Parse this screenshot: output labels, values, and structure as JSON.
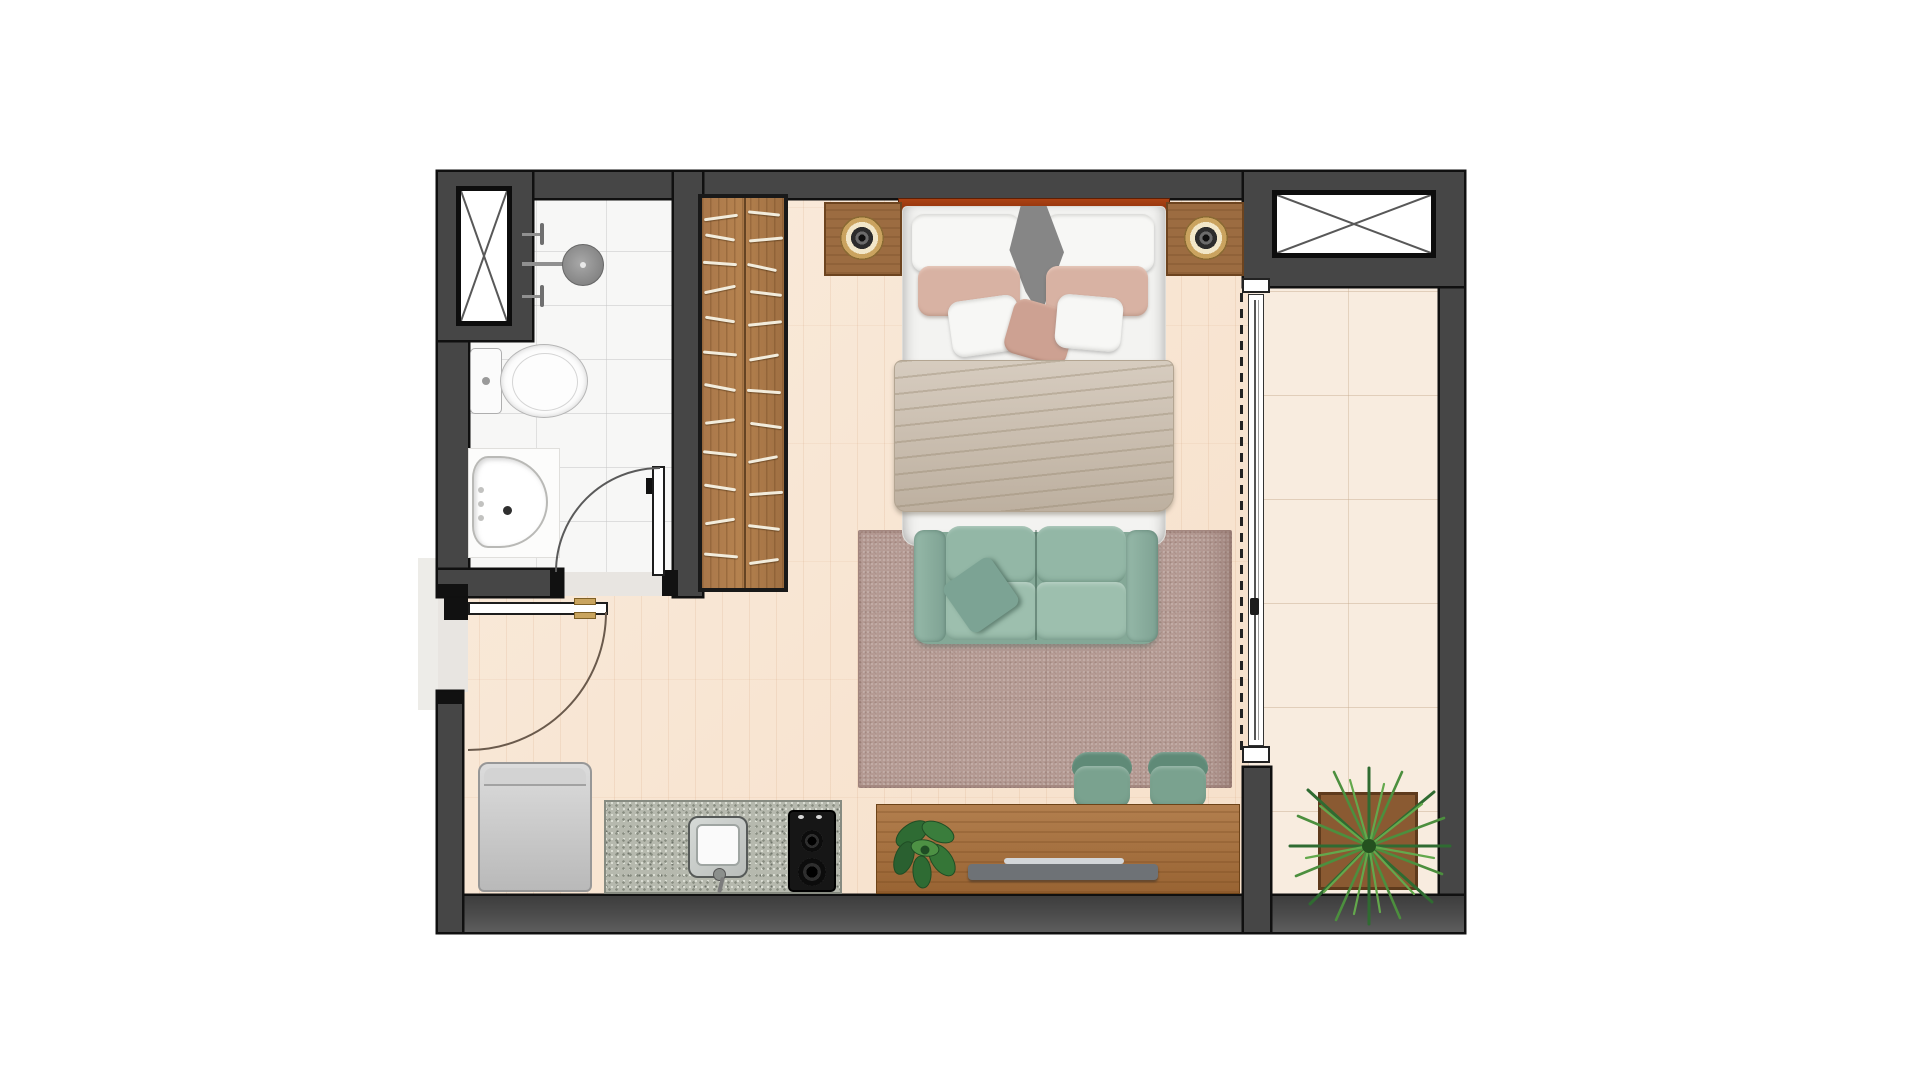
{
  "scene": {
    "type": "architectural floor plan",
    "view": "top-down render",
    "unit": "studio apartment",
    "visible_text": "none"
  },
  "rooms": [
    {
      "name": "bathroom",
      "floor": "white ceramic tile"
    },
    {
      "name": "main living sleeping area",
      "floor": "light wood plank"
    },
    {
      "name": "kitchenette",
      "floor": "light wood plank"
    },
    {
      "name": "balcony",
      "floor": "cream tile"
    }
  ],
  "furniture": {
    "shaft_top_left": {
      "name": "service shaft (crossed box)"
    },
    "shaft_top_right": {
      "name": "service shaft (crossed box)"
    },
    "shower": {
      "name": "shower head with two valves"
    },
    "toilet": {
      "name": "toilet"
    },
    "bathroom_sink": {
      "name": "washbasin"
    },
    "bathroom_door": {
      "name": "bathroom swing door"
    },
    "entry_door": {
      "name": "entry swing door"
    },
    "wardrobe": {
      "name": "wardrobe with hanging rail"
    },
    "headboard": {
      "name": "bed headboard panel"
    },
    "nightstand_left": {
      "name": "left nightstand with lamp"
    },
    "nightstand_right": {
      "name": "right nightstand with lamp"
    },
    "bed": {
      "name": "double bed with pillows and blanket"
    },
    "sofa": {
      "name": "two-seat sofa"
    },
    "rug": {
      "name": "area rug"
    },
    "chair_left": {
      "name": "dining chair"
    },
    "chair_right": {
      "name": "dining chair"
    },
    "console": {
      "name": "wood console desk"
    },
    "tv": {
      "name": "television"
    },
    "console_plant": {
      "name": "leafy plant"
    },
    "fridge": {
      "name": "refrigerator"
    },
    "counter": {
      "name": "granite kitchen counter"
    },
    "kitchen_sink": {
      "name": "kitchen sink"
    },
    "cooktop": {
      "name": "two-burner cooktop"
    },
    "sliding_door": {
      "name": "balcony sliding glass door"
    },
    "balcony_plant": {
      "name": "potted palm plant"
    }
  },
  "colors": {
    "wall": "#464646",
    "wall_outline": "#101010",
    "wood_floor": "#f8e5d1",
    "bath_tile": "#f7f7f6",
    "balcony_tile": "#f8ecdf",
    "wardrobe_wood": "#b5824f",
    "headboard": "#9c3a10",
    "nightstand": "#9c6c41",
    "bed_white": "#f3f3f1",
    "pillow_pink": "#d8b2a3",
    "blanket": "#c9bbaa",
    "sofa_teal": "#8fb3a3",
    "rug_mauve": "#b59b94",
    "chair_green": "#7aa28f",
    "console_wood": "#a56d39",
    "granite": "#b6b9ae",
    "plant_green": "#3f7d3a"
  }
}
